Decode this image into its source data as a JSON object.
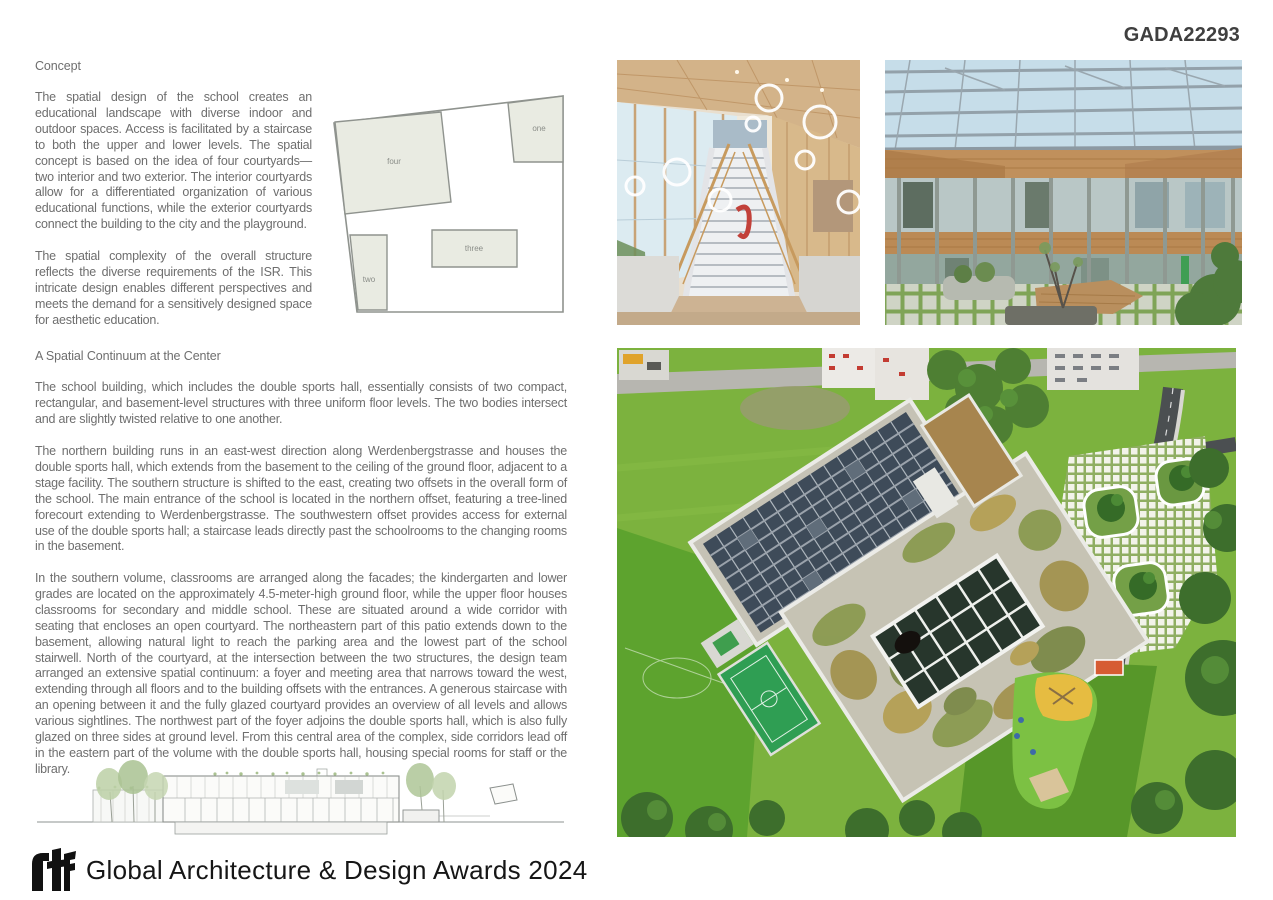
{
  "page": {
    "code": "GADA22293"
  },
  "colors": {
    "body_text": "#6e6e6e",
    "heading_text": "#3f3f3f",
    "diagram_fill": "#e9ebe2",
    "diagram_stroke": "#8f938e",
    "logo_black": "#111111"
  },
  "concept": {
    "heading": "Concept",
    "paragraphs": [
      "The spatial design of the school creates an educational landscape with diverse indoor and outdoor spaces. Access is facilitated by a staircase to both the upper and lower levels. The spatial concept is based on the idea of four courtyards—two interior and two exterior. The interior courtyards allow for a differentiated organization of various educational functions, while the exterior courtyards connect the building to the city and the playground.",
      "The spatial complexity of the overall structure reflects the diverse requirements of the ISR. This intricate design enables different perspectives and meets the demand for a sensitively designed space for aesthetic education."
    ]
  },
  "diagram": {
    "labels": {
      "one": "one",
      "two": "two",
      "three": "three",
      "four": "four"
    }
  },
  "continuum": {
    "heading": "A Spatial Continuum at the Center",
    "paragraphs": [
      "The school building, which includes the double sports hall, essentially consists of two compact, rectangular, and basement-level structures with three uniform floor levels. The two bodies intersect and are slightly twisted relative to one another.",
      "The northern building runs in an east-west direction along Werdenbergstrasse and houses the double sports hall, which extends from the basement to the ceiling of the ground floor, adjacent to a stage facility. The southern structure is shifted to the east, creating two offsets in the overall form of the school. The main entrance of the school is located in the northern offset, featuring a tree-lined forecourt extending to Werdenbergstrasse. The southwestern offset provides access for external use of the double sports hall; a staircase leads directly past the schoolrooms to the changing rooms in the basement.",
      "In the southern volume, classrooms are arranged along the facades; the kindergarten and lower grades are located on the approximately 4.5-meter-high ground floor, while the upper floor houses classrooms for secondary and middle school. These are situated around a wide corridor with seating that encloses an open courtyard. The northeastern part of this patio extends down to the basement, allowing natural light to reach the parking area and the lowest part of the school stairwell. North of the courtyard, at the intersection between the two structures, the design team arranged an extensive spatial continuum: a foyer and meeting area that narrows toward the west, extending through all floors and to the building offsets with the entrances. A generous staircase with an opening between it and the fully glazed courtyard provides an overview of all levels and allows various sightlines. The northwest part of the foyer adjoins the double sports hall, which is also fully glazed on three sides at ground level. From this central area of the complex, side corridors lead off in the eastern part of the volume with the double sports hall, housing special rooms for staff or the library."
    ]
  },
  "footer": {
    "logo_text": "rtf",
    "award_title": "Global Architecture & Design Awards 2024"
  }
}
